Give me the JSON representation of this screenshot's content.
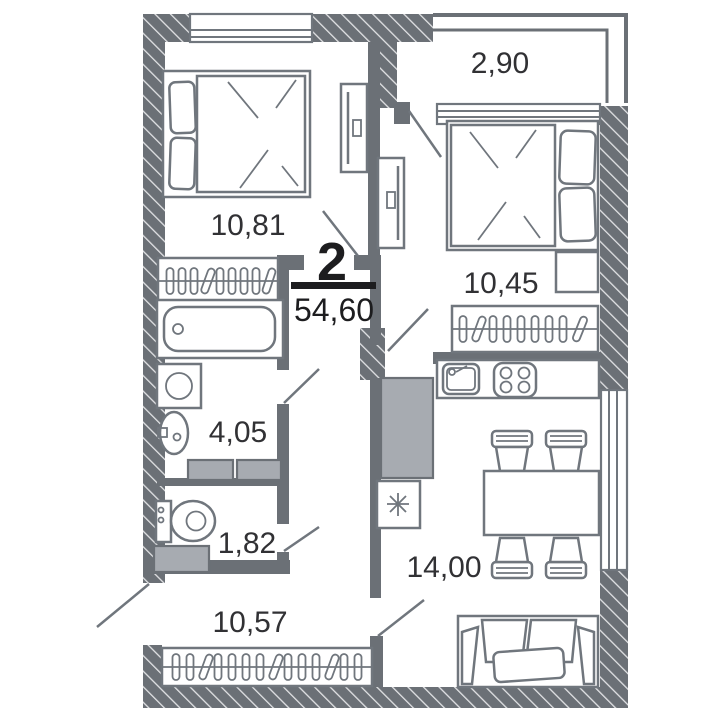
{
  "floor_plan": {
    "summary": {
      "room_count": "2",
      "total_area": "54,60"
    },
    "rooms": [
      {
        "name": "bedroom-1",
        "area": "10,81"
      },
      {
        "name": "balcony",
        "area": "2,90"
      },
      {
        "name": "bedroom-2",
        "area": "10,45"
      },
      {
        "name": "bathroom",
        "area": "4,05"
      },
      {
        "name": "toilet",
        "area": "1,82"
      },
      {
        "name": "hallway",
        "area": "10,57"
      },
      {
        "name": "kitchen-living-room",
        "area": "14,00"
      }
    ],
    "icons": {
      "fridge": "snowflake-asterisk",
      "hangers": "clothes-hangers",
      "stove": "four-burner-hob"
    },
    "colors": {
      "wall": "#6b7076",
      "stripe": "#e2e3e5",
      "line": "#70767d",
      "grayfill": "#a7abb1",
      "text": "#313134",
      "dark": "#1d1d1f"
    }
  }
}
